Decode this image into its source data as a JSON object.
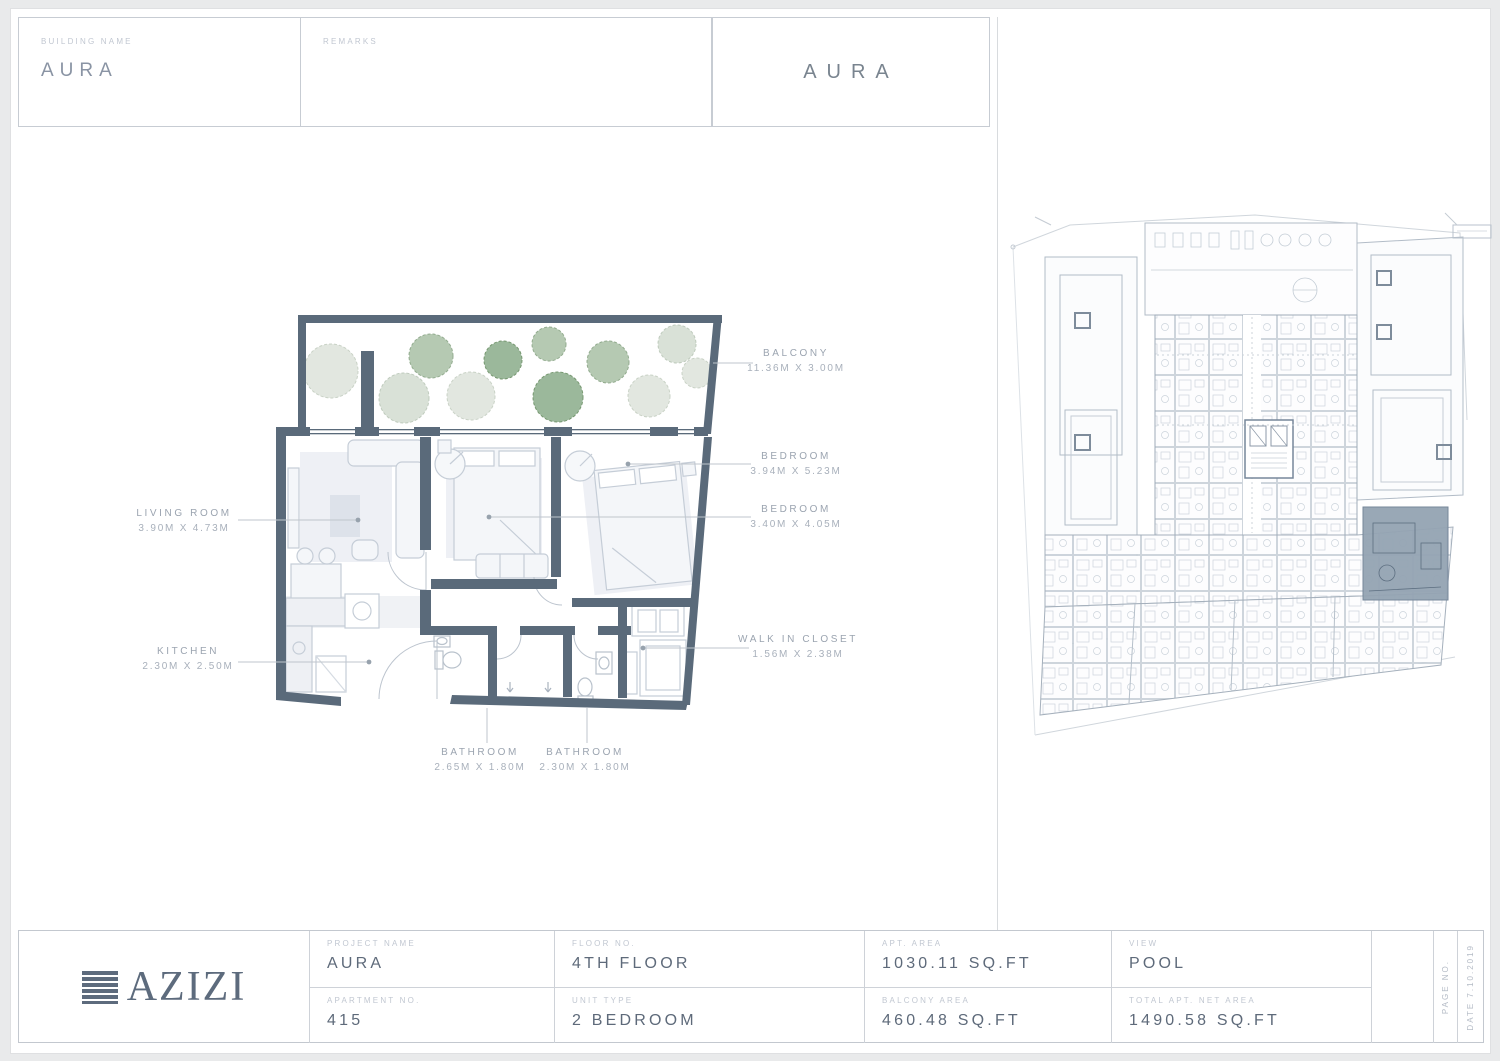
{
  "header": {
    "building_name_label": "BUILDING NAME",
    "building_name_value": "AURA",
    "remarks_label": "REMARKS",
    "plan_title": "AURA"
  },
  "floor_plan": {
    "rooms": [
      {
        "name": "BALCONY",
        "dims": "11.36M X 3.00M"
      },
      {
        "name": "BEDROOM",
        "dims": "3.94M X 5.23M"
      },
      {
        "name": "BEDROOM",
        "dims": "3.40M X 4.05M"
      },
      {
        "name": "WALK IN CLOSET",
        "dims": "1.56M X 2.38M"
      },
      {
        "name": "LIVING ROOM",
        "dims": "3.90M X 4.73M"
      },
      {
        "name": "KITCHEN",
        "dims": "2.30M X 2.50M"
      },
      {
        "name": "BATHROOM",
        "dims": "2.65M X 1.80M"
      },
      {
        "name": "BATHROOM",
        "dims": "2.30M X 1.80M"
      }
    ]
  },
  "footer": {
    "logo_text": "AZIZI",
    "cells": [
      {
        "label": "PROJECT NAME",
        "value": "AURA"
      },
      {
        "label": "FLOOR NO.",
        "value": "4TH FLOOR"
      },
      {
        "label": "APT. AREA",
        "value": "1030.11 SQ.FT"
      },
      {
        "label": "VIEW",
        "value": "POOL"
      },
      {
        "label": "APARTMENT NO.",
        "value": "415"
      },
      {
        "label": "UNIT TYPE",
        "value": "2 BEDROOM"
      },
      {
        "label": "BALCONY AREA",
        "value": "460.48 SQ.FT"
      },
      {
        "label": "TOTAL APT. NET AREA",
        "value": "1490.58 SQ.FT"
      }
    ],
    "page_no_label": "PAGE NO.",
    "date_label": "DATE 7.10.2019"
  },
  "colors": {
    "wall": "#5a6a7a",
    "value_text": "#5e6a7a",
    "caption_text": "#c1c7d1",
    "leader_line": "#bfc5cc",
    "tree_green_dark": "#8aab89",
    "tree_green_medium": "#a8c0a4",
    "tree_pale": "#dde3da",
    "key_plan_highlight": "#94a3b2"
  }
}
